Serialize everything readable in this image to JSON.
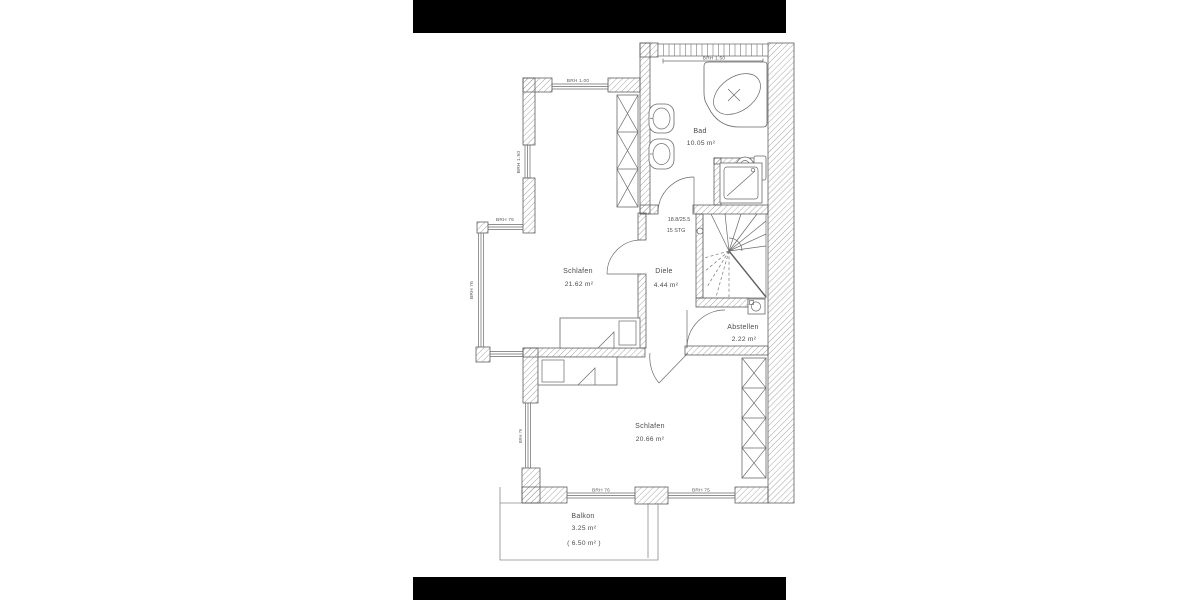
{
  "scene": {
    "background": "#ffffff",
    "letterbox_color": "#000000",
    "wall_line_color": "#555555",
    "text_color": "#4a4a4a"
  },
  "floorplan": {
    "rooms": {
      "bad": {
        "name": "Bad",
        "area": "10.05 m²"
      },
      "schlafen_oben": {
        "name": "Schlafen",
        "area": "21.62 m²"
      },
      "diele": {
        "name": "Diele",
        "area": "4.44 m²"
      },
      "abstellen": {
        "name": "Abstellen",
        "area": "2.22 m²"
      },
      "schlafen_unten": {
        "name": "Schlafen",
        "area": "20.66 m²"
      },
      "balkon": {
        "name": "Balkon",
        "area": "3.25 m²",
        "area_total": "( 6.50 m² )"
      }
    },
    "stairs": {
      "dimension": "18.8/25.5",
      "steps": "15 STG"
    },
    "windows": {
      "top": "BRH 1.00",
      "bad_top": "BRH 1.50",
      "left_upper": "BRH 1.50",
      "bay_top": "BRH 76",
      "bay_side": "BRH 76",
      "left_lower": "BRH 76",
      "bottom_left": "BRH 76",
      "bottom_right": "BRH 75"
    }
  }
}
